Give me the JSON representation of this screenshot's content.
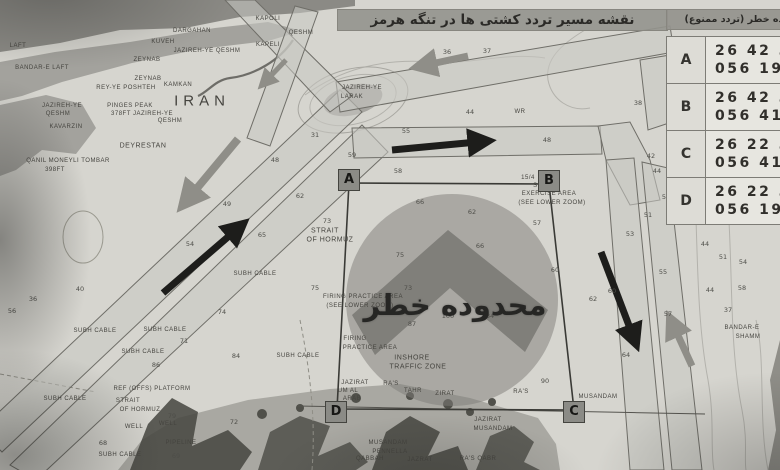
{
  "title_bar": {
    "text": "نقشه مسیر تردد کشتی ها در تنگه هرمز"
  },
  "danger_table": {
    "header": "محدوده خطر (تردد ممنوع)",
    "rows": [
      {
        "point": "A",
        "lat": "26 42 3",
        "lon": "056 19 3"
      },
      {
        "point": "B",
        "lat": "26 42 3",
        "lon": "056 41 2"
      },
      {
        "point": "C",
        "lat": "26 22 3",
        "lon": "056 41 3"
      },
      {
        "point": "D",
        "lat": "26 22 3",
        "lon": "056 19 3"
      }
    ]
  },
  "danger_zone": {
    "label": "محدوده خطر",
    "corner_boxes": [
      {
        "label": "A",
        "x": 349,
        "y": 180
      },
      {
        "label": "B",
        "x": 549,
        "y": 181
      },
      {
        "label": "C",
        "x": 574,
        "y": 412
      },
      {
        "label": "D",
        "x": 336,
        "y": 412
      }
    ]
  },
  "map_labels": [
    {
      "t": "KAPOLI",
      "x": 268,
      "y": 19
    },
    {
      "t": "QESHM",
      "x": 301,
      "y": 33
    },
    {
      "t": "KAPELI",
      "x": 268,
      "y": 45
    },
    {
      "t": "DARGAHAN",
      "x": 192,
      "y": 31
    },
    {
      "t": "KUVEH",
      "x": 163,
      "y": 42
    },
    {
      "t": "JAZIREH-YE QESHM",
      "x": 207,
      "y": 51
    },
    {
      "t": "LAFT",
      "x": 18,
      "y": 46
    },
    {
      "t": "BANDAR-E LAFT",
      "x": 42,
      "y": 68
    },
    {
      "t": "ZEYNAB",
      "x": 147,
      "y": 60
    },
    {
      "t": "ZEYNAB",
      "x": 148,
      "y": 79
    },
    {
      "t": "REY-YE POSHTEH",
      "x": 126,
      "y": 88
    },
    {
      "t": "KAMKAN",
      "x": 178,
      "y": 85
    },
    {
      "t": "IRAN",
      "x": 202,
      "y": 101,
      "s": 15,
      "ls": 5
    },
    {
      "t": "PINGES PEAK",
      "x": 130,
      "y": 106
    },
    {
      "t": "378FT JAZIREH-YE",
      "x": 142,
      "y": 114
    },
    {
      "t": "QESHM",
      "x": 170,
      "y": 121
    },
    {
      "t": "JAZIREH-YE",
      "x": 62,
      "y": 106
    },
    {
      "t": "QESHM",
      "x": 58,
      "y": 114
    },
    {
      "t": "KAVARZIN",
      "x": 66,
      "y": 127
    },
    {
      "t": "DEYRESTAN",
      "x": 143,
      "y": 146,
      "s": 7
    },
    {
      "t": "QANIL MONEYLI TOMBAR",
      "x": 68,
      "y": 161
    },
    {
      "t": "398FT",
      "x": 55,
      "y": 170
    },
    {
      "t": "JAZIREH-YE",
      "x": 362,
      "y": 88
    },
    {
      "t": "LARAK",
      "x": 352,
      "y": 97
    },
    {
      "t": "SUBH CABLE",
      "x": 95,
      "y": 331
    },
    {
      "t": "SUBH CABLE",
      "x": 165,
      "y": 330
    },
    {
      "t": "SUBH CABLE",
      "x": 143,
      "y": 352
    },
    {
      "t": "SUBH CABLE",
      "x": 65,
      "y": 399
    },
    {
      "t": "SUBH CABLE",
      "x": 120,
      "y": 455
    },
    {
      "t": "SUBH CABLE",
      "x": 255,
      "y": 274
    },
    {
      "t": "SUBH CABLE",
      "x": 298,
      "y": 356
    },
    {
      "t": "REF (OFFS) PLATFORM",
      "x": 152,
      "y": 389
    },
    {
      "t": "STRAIT",
      "x": 128,
      "y": 401
    },
    {
      "t": "OF HORMUZ",
      "x": 140,
      "y": 410
    },
    {
      "t": "WELL",
      "x": 134,
      "y": 427
    },
    {
      "t": "WELL",
      "x": 168,
      "y": 424
    },
    {
      "t": "PIPELINE",
      "x": 181,
      "y": 443
    },
    {
      "t": "STRAIT",
      "x": 325,
      "y": 231,
      "s": 7
    },
    {
      "t": "OF HORMUZ",
      "x": 330,
      "y": 240,
      "s": 7
    },
    {
      "t": "FIRING PRACTICE AREA",
      "x": 363,
      "y": 297
    },
    {
      "t": "(SEE LOWER ZOOM)",
      "x": 360,
      "y": 306
    },
    {
      "t": "FIRING",
      "x": 355,
      "y": 339
    },
    {
      "t": "PRACTICE AREA",
      "x": 370,
      "y": 348
    },
    {
      "t": "INSHORE",
      "x": 412,
      "y": 358,
      "s": 7
    },
    {
      "t": "TRAFFIC ZONE",
      "x": 418,
      "y": 367,
      "s": 7
    },
    {
      "t": "15/4",
      "x": 528,
      "y": 178
    },
    {
      "t": "SUB",
      "x": 540,
      "y": 186
    },
    {
      "t": "EXERCISE AREA",
      "x": 549,
      "y": 194
    },
    {
      "t": "(SEE LOWER ZOOM)",
      "x": 552,
      "y": 203
    },
    {
      "t": "WR",
      "x": 520,
      "y": 112
    },
    {
      "t": "RA'S",
      "x": 391,
      "y": 384
    },
    {
      "t": "TAHR",
      "x": 413,
      "y": 391
    },
    {
      "t": "JAZIRAT",
      "x": 355,
      "y": 383
    },
    {
      "t": "UM AL",
      "x": 348,
      "y": 391
    },
    {
      "t": "ARAB",
      "x": 352,
      "y": 399
    },
    {
      "t": "ZIRAT",
      "x": 445,
      "y": 394
    },
    {
      "t": "RA'S",
      "x": 521,
      "y": 392
    },
    {
      "t": "MUSANDAM",
      "x": 598,
      "y": 397
    },
    {
      "t": "JAZIRAT",
      "x": 488,
      "y": 420
    },
    {
      "t": "MUSANDAM",
      "x": 493,
      "y": 429
    },
    {
      "t": "MUSANDAM",
      "x": 388,
      "y": 443
    },
    {
      "t": "PENNELLA",
      "x": 390,
      "y": 452
    },
    {
      "t": "QABBAH",
      "x": 370,
      "y": 459
    },
    {
      "t": "JAZRAT",
      "x": 420,
      "y": 460
    },
    {
      "t": "RA'S QABR",
      "x": 478,
      "y": 459
    },
    {
      "t": "BANDAR-E",
      "x": 742,
      "y": 328
    },
    {
      "t": "SHAMM",
      "x": 748,
      "y": 337
    }
  ],
  "depth_numbers": [
    {
      "v": "36",
      "x": 447,
      "y": 52
    },
    {
      "v": "37",
      "x": 487,
      "y": 51
    },
    {
      "v": "44",
      "x": 470,
      "y": 112
    },
    {
      "v": "31",
      "x": 315,
      "y": 135
    },
    {
      "v": "59",
      "x": 352,
      "y": 155
    },
    {
      "v": "55",
      "x": 406,
      "y": 131
    },
    {
      "v": "48",
      "x": 547,
      "y": 140
    },
    {
      "v": "48",
      "x": 275,
      "y": 160
    },
    {
      "v": "58",
      "x": 398,
      "y": 171
    },
    {
      "v": "62",
      "x": 300,
      "y": 196
    },
    {
      "v": "66",
      "x": 420,
      "y": 202
    },
    {
      "v": "62",
      "x": 472,
      "y": 212
    },
    {
      "v": "57",
      "x": 537,
      "y": 223
    },
    {
      "v": "65",
      "x": 262,
      "y": 235
    },
    {
      "v": "54",
      "x": 190,
      "y": 244
    },
    {
      "v": "49",
      "x": 227,
      "y": 204
    },
    {
      "v": "73",
      "x": 327,
      "y": 221
    },
    {
      "v": "75",
      "x": 400,
      "y": 255
    },
    {
      "v": "66",
      "x": 480,
      "y": 246
    },
    {
      "v": "75",
      "x": 315,
      "y": 288
    },
    {
      "v": "73",
      "x": 408,
      "y": 288
    },
    {
      "v": "60",
      "x": 555,
      "y": 270
    },
    {
      "v": "100",
      "x": 448,
      "y": 316
    },
    {
      "v": "84",
      "x": 490,
      "y": 316
    },
    {
      "v": "87",
      "x": 412,
      "y": 324
    },
    {
      "v": "90",
      "x": 545,
      "y": 381
    },
    {
      "v": "38",
      "x": 638,
      "y": 103
    },
    {
      "v": "42",
      "x": 651,
      "y": 156
    },
    {
      "v": "44",
      "x": 657,
      "y": 171
    },
    {
      "v": "50",
      "x": 666,
      "y": 197
    },
    {
      "v": "51",
      "x": 648,
      "y": 215
    },
    {
      "v": "53",
      "x": 630,
      "y": 234
    },
    {
      "v": "55",
      "x": 663,
      "y": 272
    },
    {
      "v": "62",
      "x": 593,
      "y": 299
    },
    {
      "v": "60",
      "x": 612,
      "y": 291
    },
    {
      "v": "57",
      "x": 668,
      "y": 314
    },
    {
      "v": "64",
      "x": 626,
      "y": 355
    },
    {
      "v": "44",
      "x": 705,
      "y": 244
    },
    {
      "v": "51",
      "x": 723,
      "y": 257
    },
    {
      "v": "54",
      "x": 743,
      "y": 262
    },
    {
      "v": "58",
      "x": 742,
      "y": 288
    },
    {
      "v": "44",
      "x": 710,
      "y": 290
    },
    {
      "v": "37",
      "x": 728,
      "y": 310
    },
    {
      "v": "74",
      "x": 222,
      "y": 312
    },
    {
      "v": "71",
      "x": 184,
      "y": 341
    },
    {
      "v": "84",
      "x": 236,
      "y": 356
    },
    {
      "v": "86",
      "x": 156,
      "y": 365
    },
    {
      "v": "79",
      "x": 172,
      "y": 416
    },
    {
      "v": "72",
      "x": 234,
      "y": 422
    },
    {
      "v": "68",
      "x": 103,
      "y": 443
    },
    {
      "v": "69",
      "x": 176,
      "y": 456
    },
    {
      "v": "36",
      "x": 33,
      "y": 299
    },
    {
      "v": "40",
      "x": 80,
      "y": 289
    },
    {
      "v": "56",
      "x": 12,
      "y": 311
    }
  ],
  "arrows": [
    {
      "c": "black",
      "x1": 163,
      "y1": 293,
      "x2": 243,
      "y2": 224,
      "w": 7
    },
    {
      "c": "black",
      "x1": 392,
      "y1": 150,
      "x2": 488,
      "y2": 141,
      "w": 7
    },
    {
      "c": "black",
      "x1": 601,
      "y1": 252,
      "x2": 636,
      "y2": 344,
      "w": 7
    },
    {
      "c": "gray",
      "x1": 238,
      "y1": 139,
      "x2": 183,
      "y2": 205,
      "w": 8
    },
    {
      "c": "gray",
      "x1": 468,
      "y1": 56,
      "x2": 417,
      "y2": 67,
      "w": 7
    },
    {
      "c": "gray",
      "x1": 692,
      "y1": 366,
      "x2": 670,
      "y2": 318,
      "w": 7
    },
    {
      "c": "gray",
      "x1": 286,
      "y1": 60,
      "x2": 262,
      "y2": 85,
      "w": 5
    }
  ],
  "colors": {
    "sea": "#d6d5cf",
    "land": "#a3a29d",
    "land_dark": "#45453f",
    "lane_fill": "#c9c8c2",
    "lane_stroke": "#6f6e68",
    "arrow_black": "#1d1d1b",
    "arrow_gray": "#8f8e88",
    "danger_circle": "rgba(125,124,120,0.5)",
    "danger_chevron": "rgba(85,85,82,0.5)"
  }
}
